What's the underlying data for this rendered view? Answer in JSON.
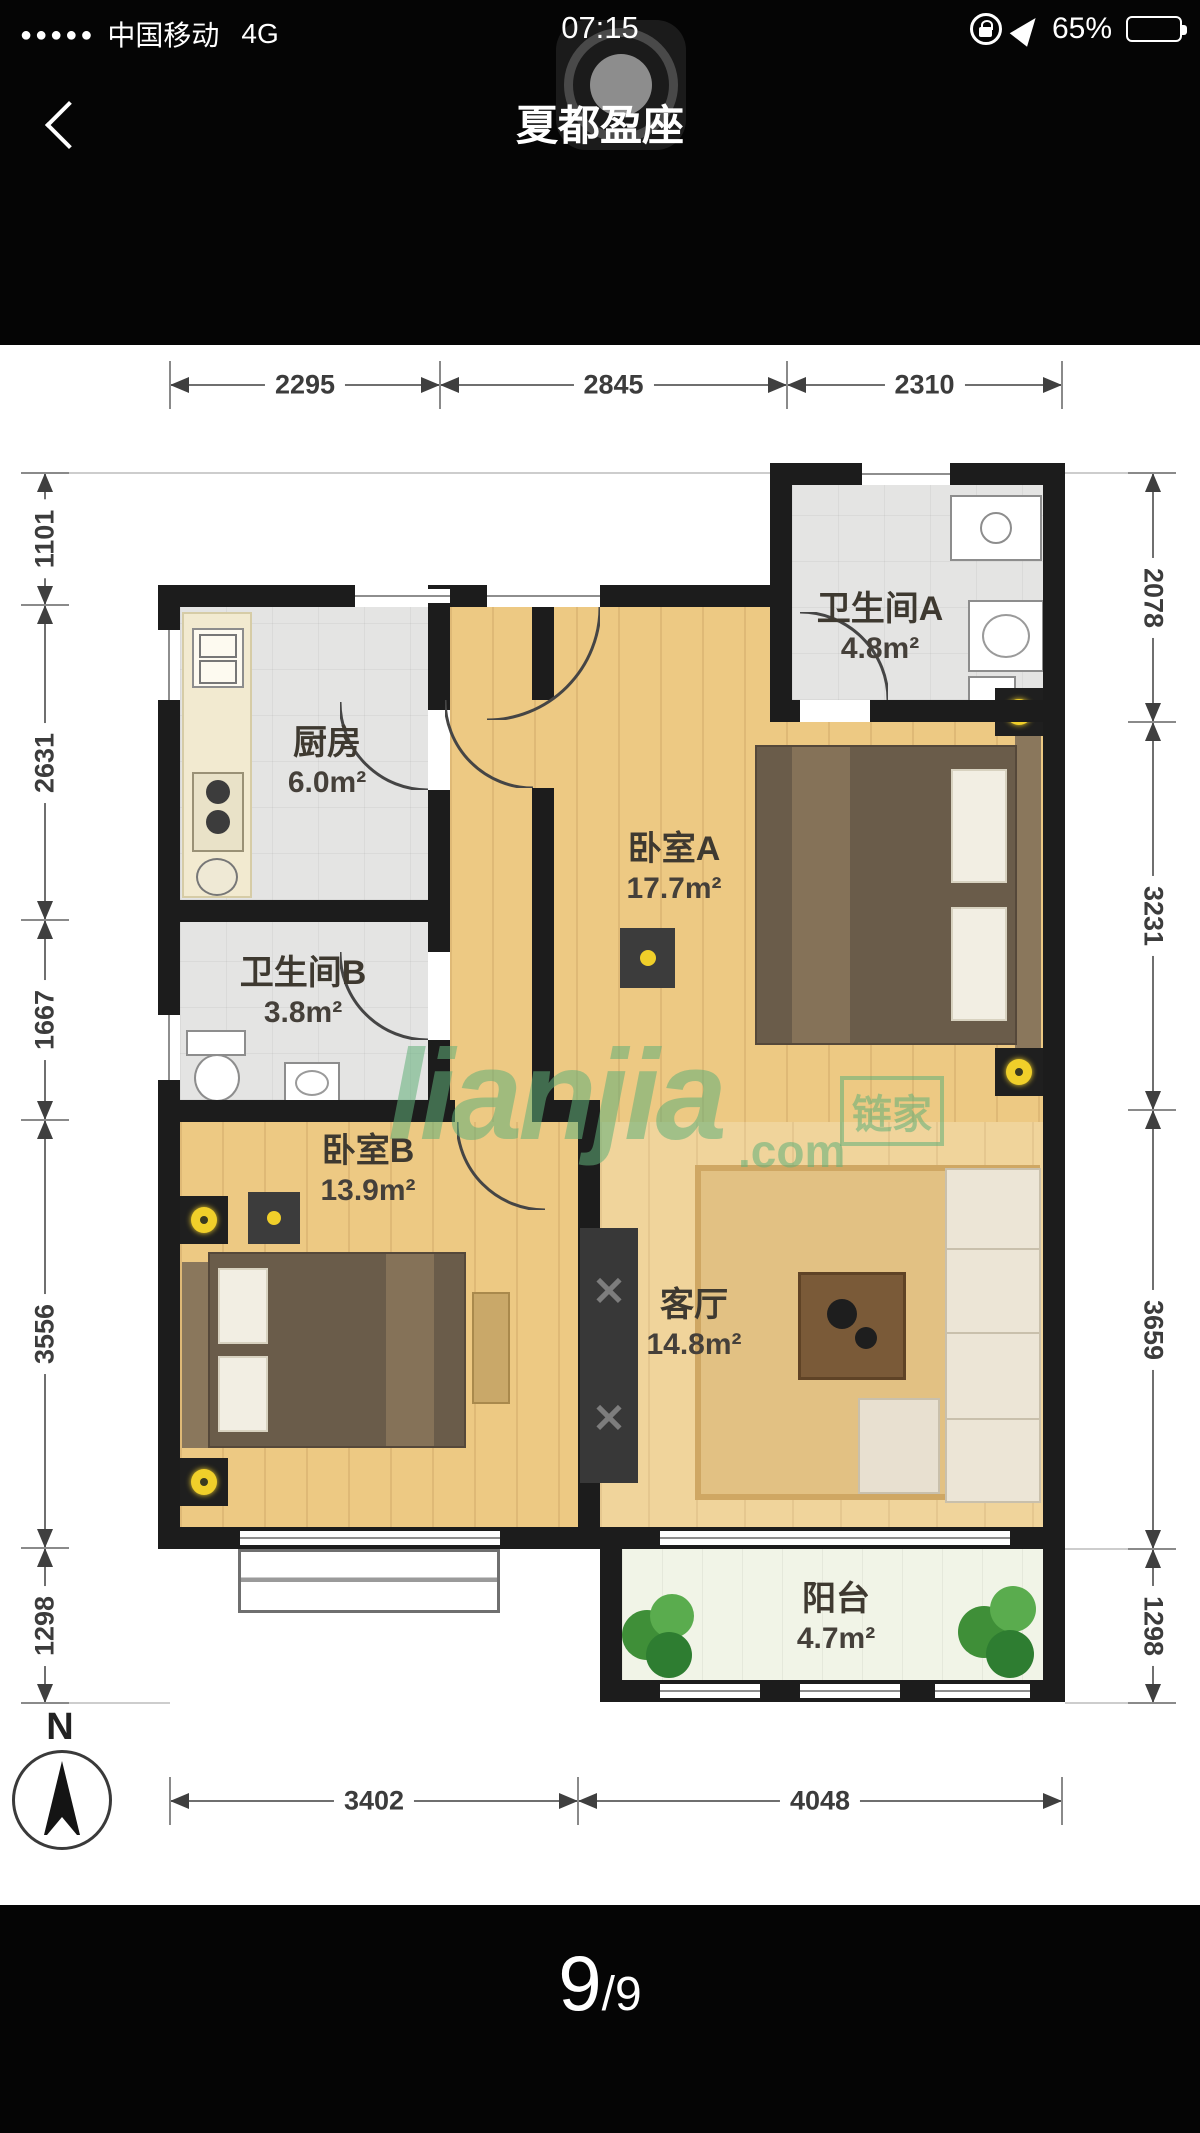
{
  "status_bar": {
    "signal_dots": "●●●●●",
    "carrier": "中国移动",
    "network": "4G",
    "time": "07:15",
    "battery_percent": "65%"
  },
  "nav_bar": {
    "title": "夏都盈座"
  },
  "floor_plan": {
    "rooms": [
      {
        "name": "卫生间A",
        "area": "4.8m²"
      },
      {
        "name": "厨房",
        "area": "6.0m²"
      },
      {
        "name": "卧室A",
        "area": "17.7m²"
      },
      {
        "name": "卫生间B",
        "area": "3.8m²"
      },
      {
        "name": "卧室B",
        "area": "13.9m²"
      },
      {
        "name": "客厅",
        "area": "14.8m²"
      },
      {
        "name": "阳台",
        "area": "4.7m²"
      }
    ],
    "dimensions_mm": {
      "top": [
        "2295",
        "2845",
        "2310"
      ],
      "bottom": [
        "3402",
        "4048"
      ],
      "left": [
        "1101",
        "2631",
        "1667",
        "3556",
        "1298"
      ],
      "right": [
        "2078",
        "3231",
        "3659",
        "1298"
      ]
    },
    "compass_label": "N",
    "watermark": {
      "script": "lianjia",
      "domain": ".com",
      "logo_text": "链家"
    }
  },
  "pager": {
    "current": "9",
    "divider": "/",
    "total": "9"
  },
  "colors": {
    "wall": "#1c1c1c",
    "wood_floor": "#edc983",
    "tile_floor": "#e4e4e3",
    "watermark_green": "#60af78",
    "lamp_yellow": "#f0cf2a"
  }
}
